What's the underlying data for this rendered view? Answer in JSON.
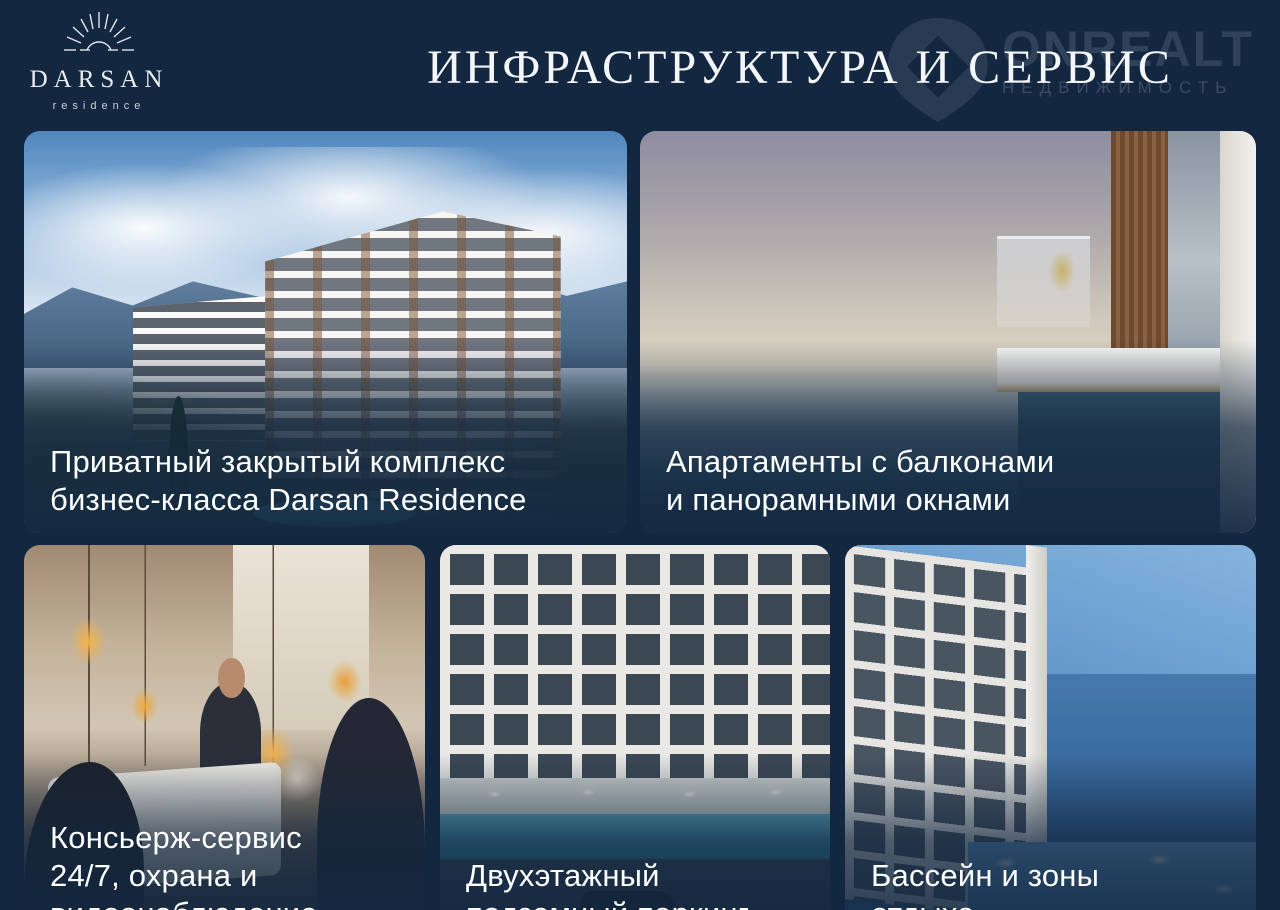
{
  "logo": {
    "brand": "DARSAN",
    "subtitle": "residence",
    "icon": "sunburst-icon"
  },
  "header": {
    "title": "ИНФРАСТРУКТУРА И СЕРВИС"
  },
  "watermark": {
    "brand": "ONREALT",
    "subtitle": "НЕДВИЖИМОСТЬ",
    "icon": "map-pin-icon"
  },
  "cards": [
    {
      "photo": "residential-complex-in-mountains",
      "caption_lines": {
        "l1": "Приватный закрытый комплекс",
        "l2": "бизнес-класса Darsan Residence",
        "l3": ""
      }
    },
    {
      "photo": "balcony-panoramic-sea-view",
      "caption_lines": {
        "l1": "Апартаменты с балконами",
        "l2": "и панорамными окнами",
        "l3": ""
      }
    },
    {
      "photo": "reception-concierge-desk",
      "caption_lines": {
        "l1": "Консьерж-сервис",
        "l2": "24/7, охрана и",
        "l3": "видеонаблюдение"
      }
    },
    {
      "photo": "building-pool-parking",
      "caption_lines": {
        "l1": "Двухэтажный",
        "l2": "подземный паркинг",
        "l3": ""
      }
    },
    {
      "photo": "pool-and-sea-recreation",
      "caption_lines": {
        "l1": "Бассейн и зоны",
        "l2": "отдыха",
        "l3": ""
      }
    }
  ],
  "colors": {
    "background": "#132740",
    "title_text": "#f3f6fa",
    "caption_text": "#fdfeff",
    "watermark_text": "rgba(198,209,223,0.16)"
  }
}
